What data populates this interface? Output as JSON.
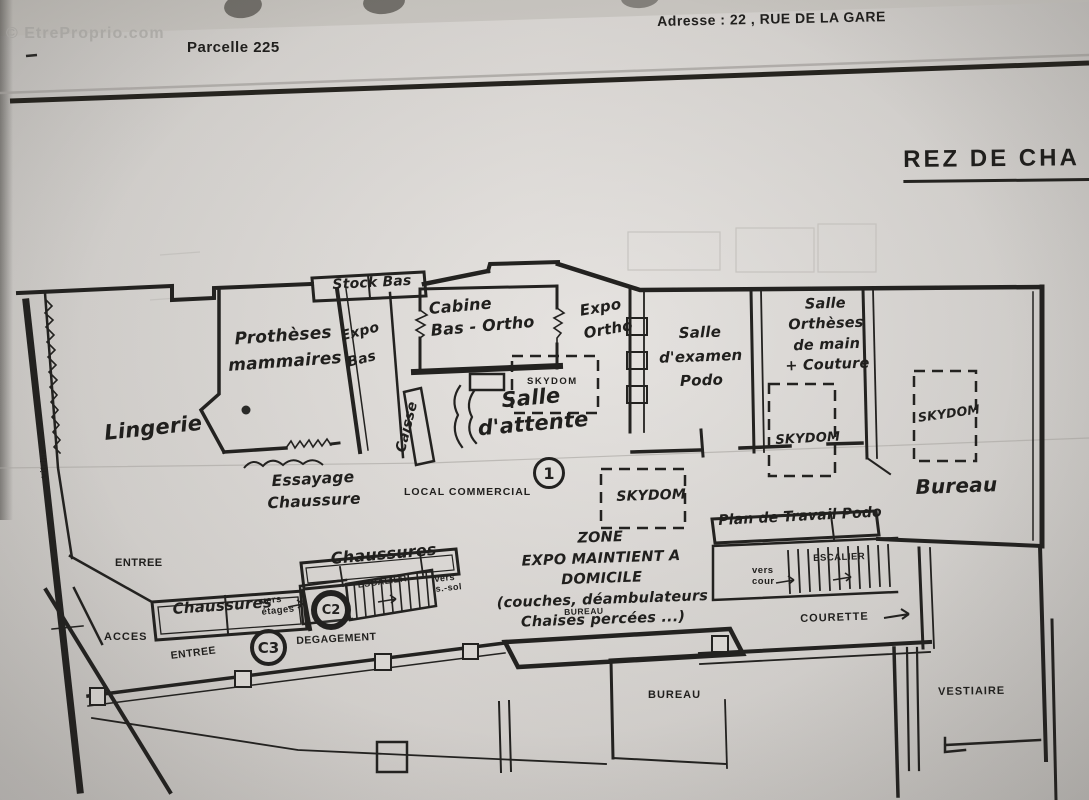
{
  "watermark": "© EtreProprio.com",
  "header": {
    "parcel": "Parcelle  225",
    "address": "Adresse : 22 , RUE DE LA GARE",
    "floor_title": "REZ DE CHA"
  },
  "plan": {
    "rooms": {
      "lingerie": "Lingerie",
      "protheses": "Prothèses\nmammaires",
      "expo_bas": "Expo\nBas",
      "stock_bas": "Stock Bas",
      "cabine_bas_ortho": "Cabine\nBas - Ortho",
      "expo_ortho": "Expo\nOrtho",
      "salle_attente": "Salle\nd'attente",
      "caisse": "Caisse",
      "salle_examen": "Salle\nd'examen\nPodo",
      "salle_ortheses": "Salle\nOrthèses\nde main\n+ Couture",
      "bureau_droit": "Bureau",
      "essayage": "Essayage\nChaussure",
      "local_commercial": "LOCAL  COMMERCIAL",
      "zone_expo": "ZONE\nEXPO MAINTIENT A\nDOMICILE\n(couches, déambulateurs\nChaises percées ...)",
      "bureau_petit": "BUREAU",
      "plan_travail": "Plan de Travail Podo",
      "courette": "COURETTE",
      "chaussures_haut": "Chaussures",
      "chaussures_gauche": "Chaussures",
      "entree_haut": "ENTREE",
      "acces": "ACCES",
      "entree_bas": "ENTREE",
      "degagement": "DEGAGEMENT",
      "bureau_bas": "BUREAU",
      "vestiaire": "VESTIAIRE",
      "vitrine": "vitrine"
    },
    "skydoms": {
      "s1": "SKYDOM",
      "s2": "SKYDOM",
      "s3": "SKYDOM",
      "s4": "SKYDOM"
    },
    "stairs": {
      "escalier_centre": "ESCALIER",
      "escalier_droit": "ESCALIER",
      "vers_etages": "vers\nétages",
      "vers_sous_sol": "vers\ns.-sol",
      "vers_cour": "vers\ncour"
    },
    "markers": {
      "one": "1",
      "c2": "C2",
      "c3": "C3"
    }
  }
}
